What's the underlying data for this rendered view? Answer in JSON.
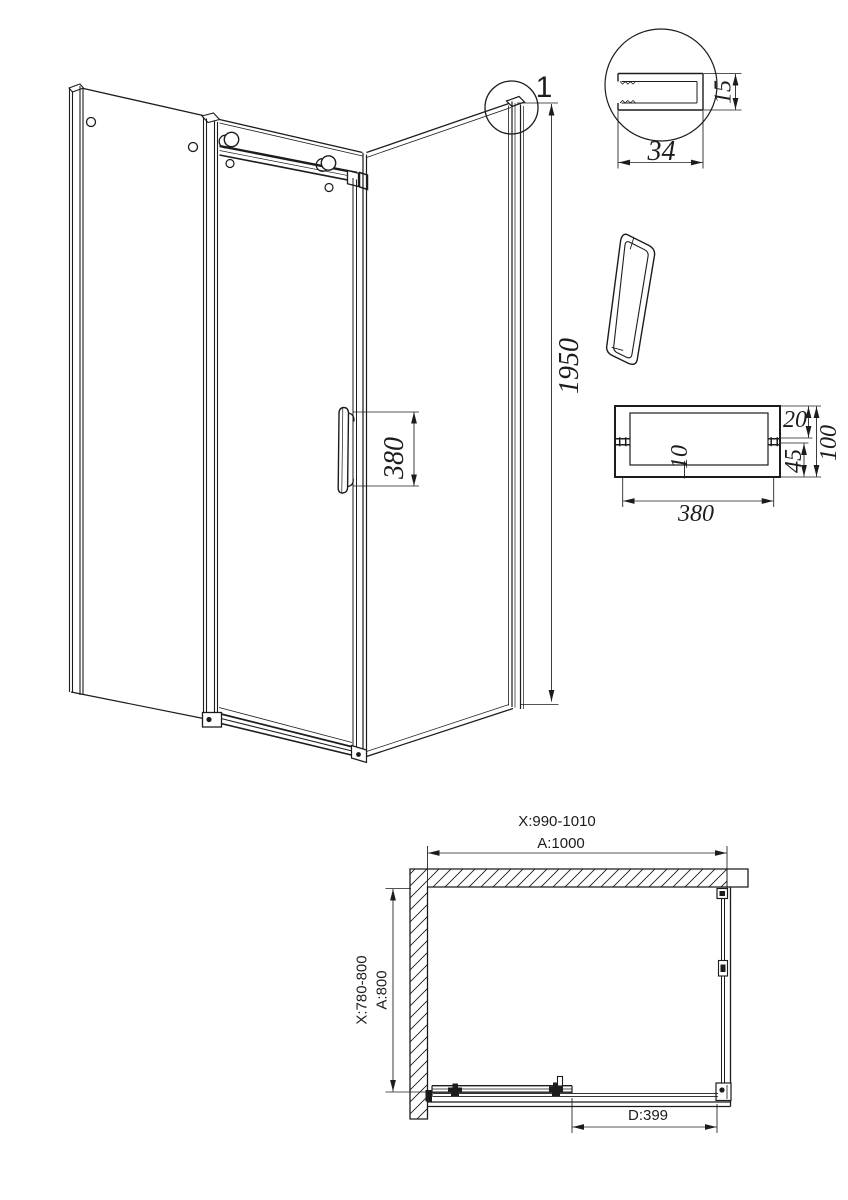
{
  "colors": {
    "ink": "#1c1c1c",
    "paper": "#ffffff"
  },
  "iso_view": {
    "detail_label": "1",
    "height_dim": "1950",
    "handle_height_dim": "380"
  },
  "profile_detail_view": {
    "width_dim": "34",
    "depth_dim": "15"
  },
  "handle_section_view": {
    "length_dim": "380",
    "top_bar_dim": "20",
    "overall_height_dim": "100",
    "bar_thickness_dim": "10",
    "lower_bar_dim": "45"
  },
  "plan_view": {
    "width_adjustment_range": "X:990-1010",
    "width_nominal": "A:1000",
    "depth_adjustment_range": "X:780-800",
    "depth_nominal": "A:800",
    "door_opening_dim": "D:399"
  }
}
